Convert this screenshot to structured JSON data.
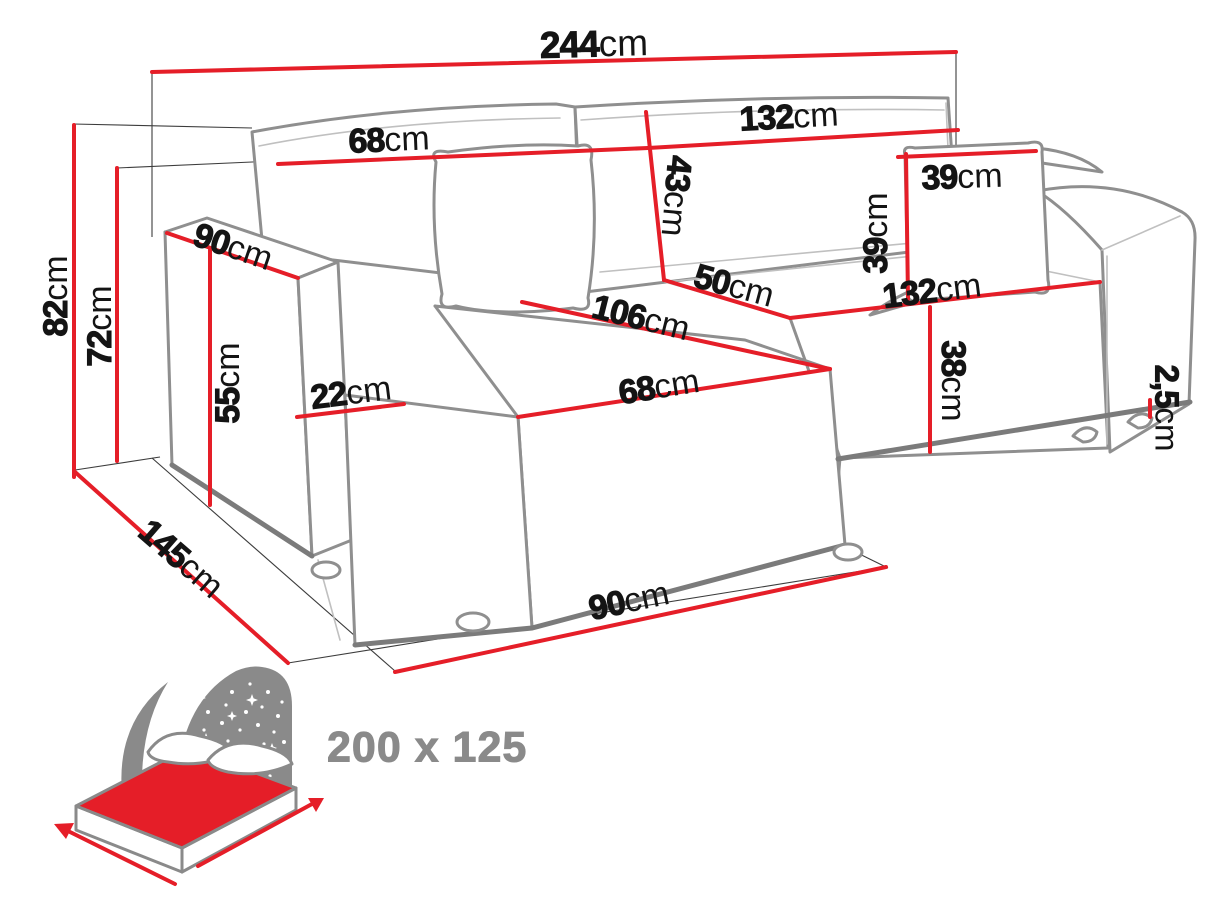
{
  "colors": {
    "dimension_red": "#e51e28",
    "outline_gray": "#8f8f8f",
    "icon_gray": "#8a8a8a",
    "label_black": "#141414"
  },
  "diagram": {
    "type": "furniture-dimension-diagram",
    "subject": "corner sofa line drawing with red dimension lines",
    "unit": "cm",
    "dimensions": [
      {
        "id": "total-width",
        "value": "244",
        "unit": "cm"
      },
      {
        "id": "back-left-width",
        "value": "68",
        "unit": "cm"
      },
      {
        "id": "back-right-width",
        "value": "132",
        "unit": "cm"
      },
      {
        "id": "backrest-height",
        "value": "43",
        "unit": "cm"
      },
      {
        "id": "pillow-width",
        "value": "39",
        "unit": "cm"
      },
      {
        "id": "pillow-height",
        "value": "39",
        "unit": "cm"
      },
      {
        "id": "armrest-length",
        "value": "90",
        "unit": "cm"
      },
      {
        "id": "total-height",
        "value": "82",
        "unit": "cm"
      },
      {
        "id": "frame-height",
        "value": "72",
        "unit": "cm"
      },
      {
        "id": "armrest-height",
        "value": "55",
        "unit": "cm"
      },
      {
        "id": "armrest-width",
        "value": "22",
        "unit": "cm"
      },
      {
        "id": "chaise-depth",
        "value": "106",
        "unit": "cm"
      },
      {
        "id": "seat-depth",
        "value": "50",
        "unit": "cm"
      },
      {
        "id": "chaise-width",
        "value": "68",
        "unit": "cm"
      },
      {
        "id": "seat-width",
        "value": "132",
        "unit": "cm"
      },
      {
        "id": "seat-height",
        "value": "38",
        "unit": "cm"
      },
      {
        "id": "leg-height",
        "value": "2,5",
        "unit": "cm"
      },
      {
        "id": "total-depth",
        "value": "145",
        "unit": "cm"
      },
      {
        "id": "front-width",
        "value": "90",
        "unit": "cm"
      }
    ],
    "sleeping_area": {
      "icon": "bed-sleeping-function-icon",
      "label": "200 x 125"
    }
  }
}
